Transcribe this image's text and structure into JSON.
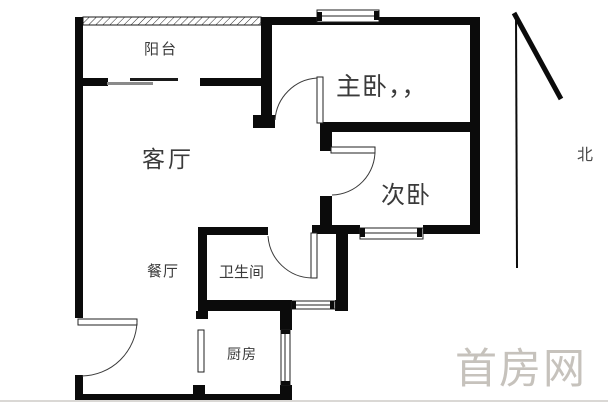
{
  "floorplan": {
    "rooms": [
      {
        "id": "balcony",
        "label": "阳台"
      },
      {
        "id": "living-room",
        "label": "客厅"
      },
      {
        "id": "dining-room",
        "label": "餐厅"
      },
      {
        "id": "master-bedroom",
        "label": "主卧，，"
      },
      {
        "id": "second-bedroom",
        "label": "次卧"
      },
      {
        "id": "bathroom",
        "label": "卫生间"
      },
      {
        "id": "kitchen",
        "label": "厨房"
      }
    ],
    "compass": {
      "north_label": "北"
    },
    "watermark": {
      "text": "首房网"
    },
    "colors": {
      "background": "#ffffff",
      "wall": "#0b0b0b",
      "door_arc": "#3a3a3a",
      "label_text": "#3a3a3a",
      "watermark_text": "#c6c2bc",
      "slider_dark_leaf": "#1a1a1a",
      "slider_gray_leaf": "#8a8a8a"
    }
  }
}
